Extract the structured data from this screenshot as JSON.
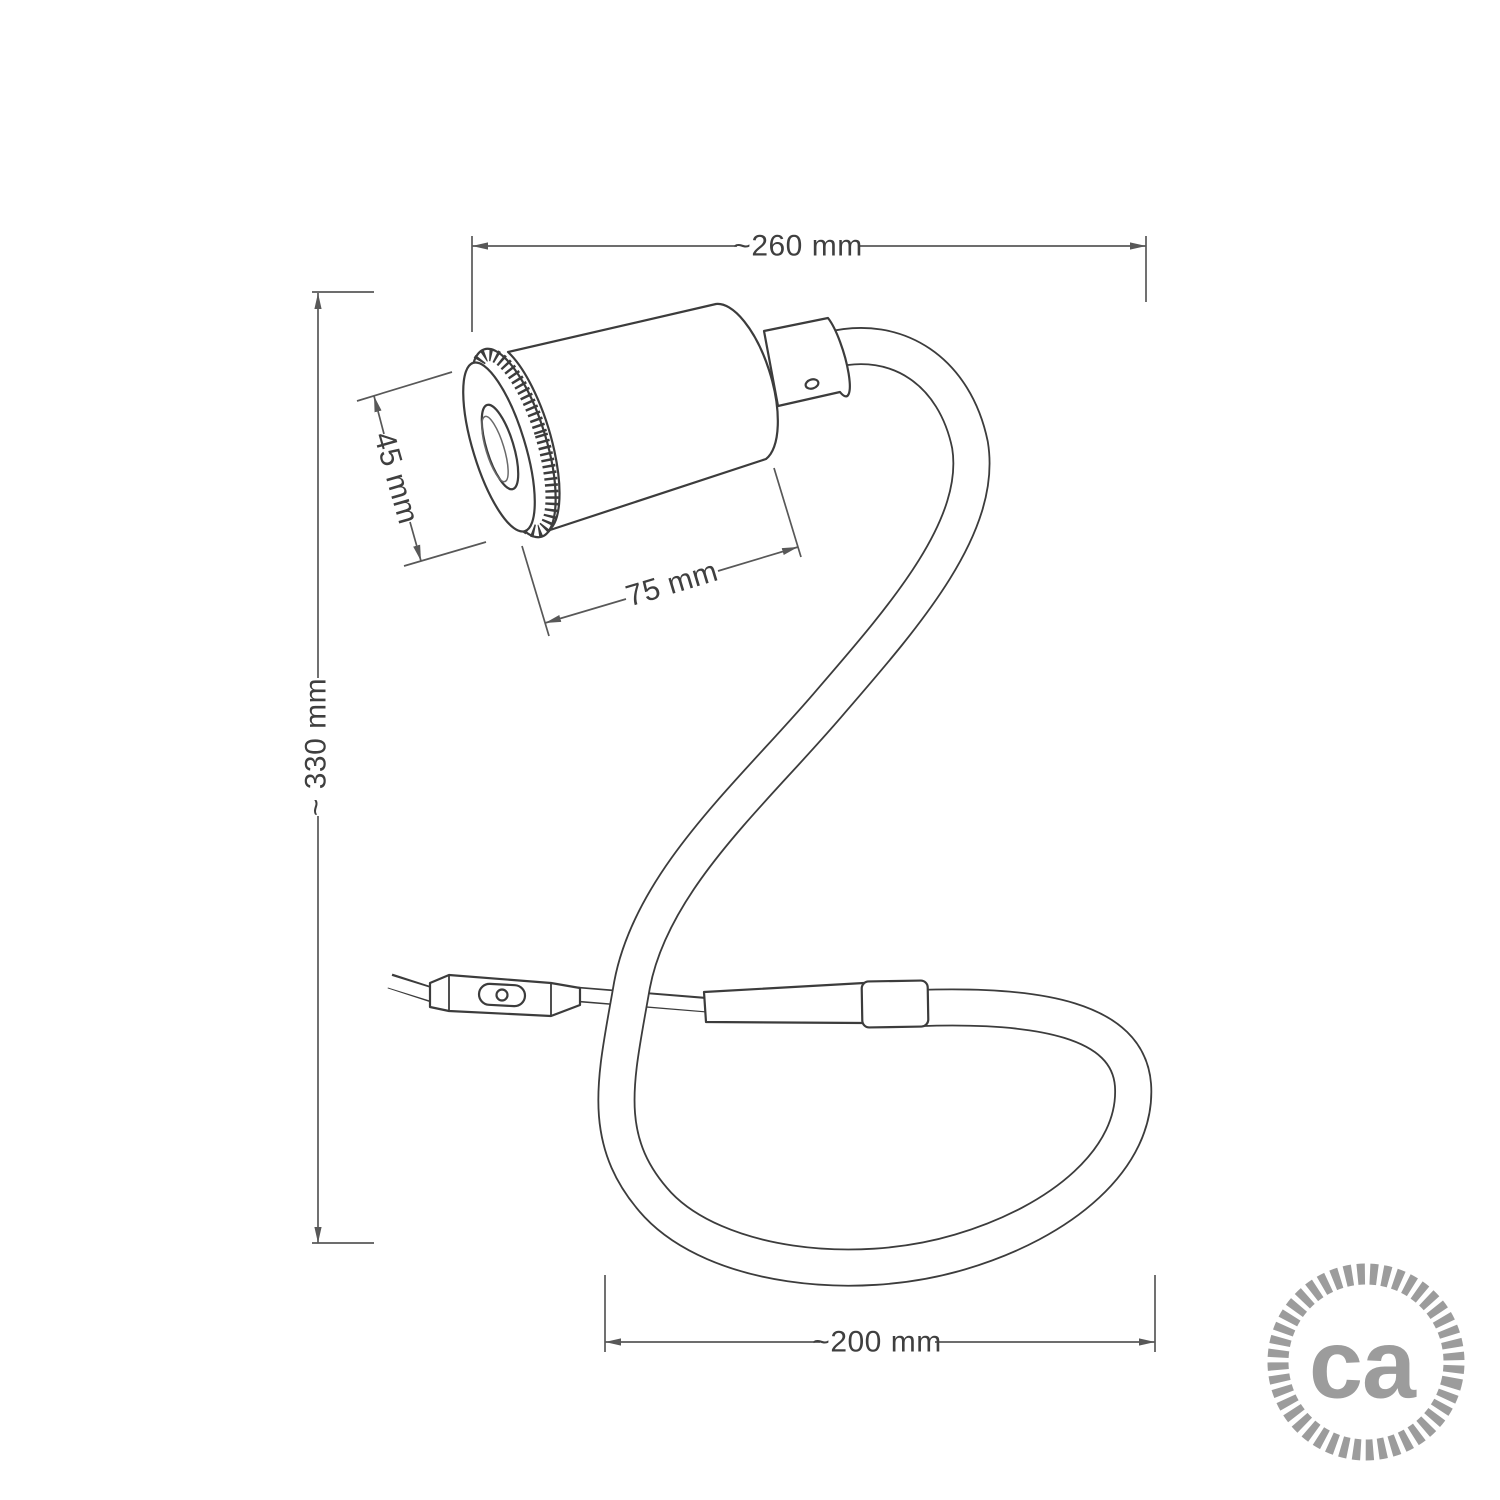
{
  "drawing": {
    "subject": "flexible gooseneck spot lamp technical drawing",
    "background": "#ffffff",
    "line_color": "#3c3c3c",
    "dimension_line_color": "#585858",
    "text_color": "#3f3f3f"
  },
  "dimensions": {
    "overall_width": "~260 mm",
    "overall_height": "~ 330 mm",
    "loop_width": "~200 mm",
    "head_diameter": "45 mm",
    "head_length": "75 mm"
  },
  "logo": {
    "text": "ca",
    "color": "#9c9c9c"
  }
}
